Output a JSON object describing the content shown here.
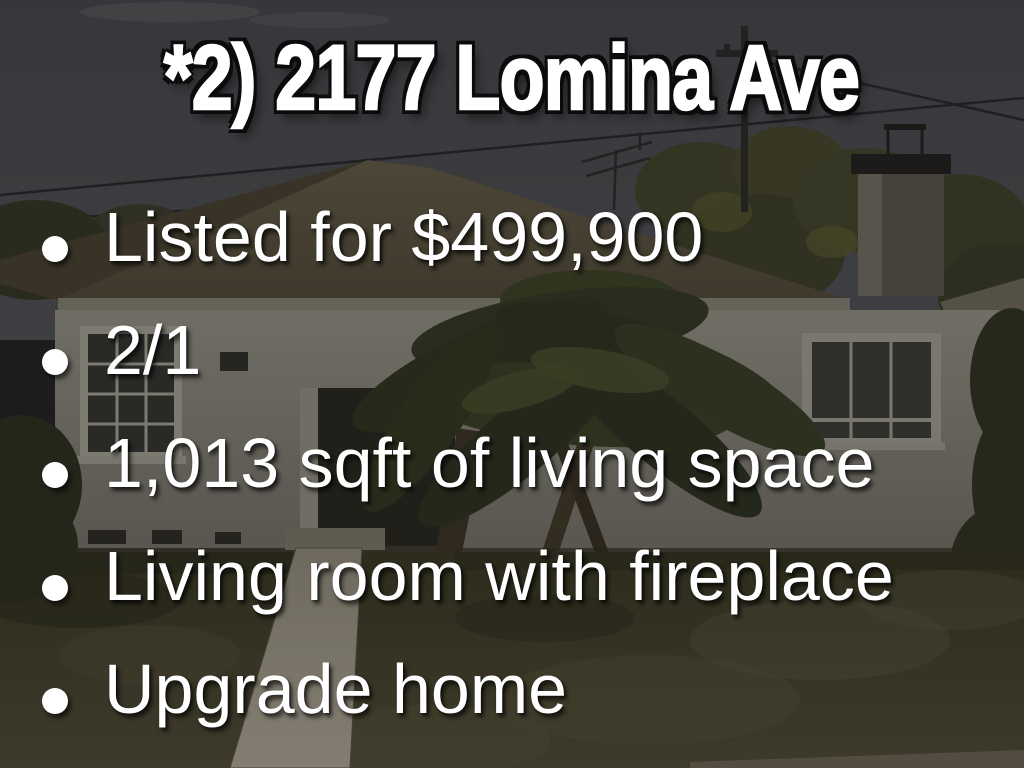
{
  "slide": {
    "title": "*2) 2177 Lomina Ave",
    "bullets": [
      "Listed for $499,900",
      "2/1",
      "1,013 sqft of living space",
      "Living room with fireplace",
      "Upgrade home"
    ],
    "background_photo": "darkened street-view photo of a single-story house with palm tree, chimney, front lawn and concrete walkway",
    "colors": {
      "text": "#ffffff",
      "title_outline": "#0b0b0c",
      "sky": "#47494e",
      "roof": "#574f3e",
      "wall": "#89867b",
      "lawn": "#44412d",
      "walkway": "#9a9384"
    }
  }
}
